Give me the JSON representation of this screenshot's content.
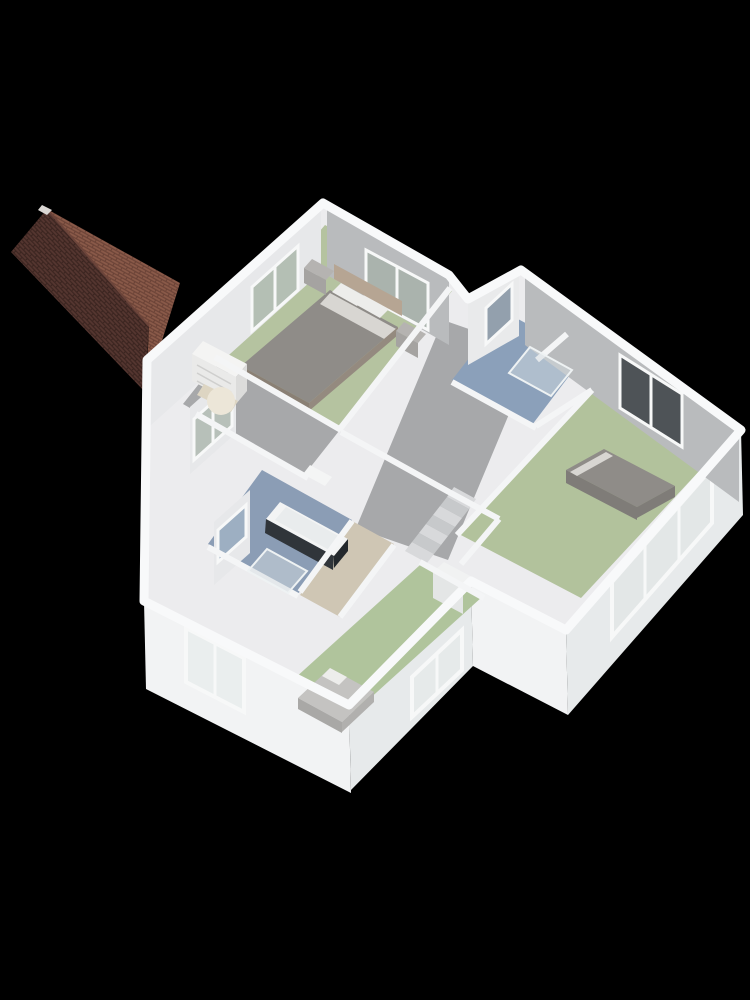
{
  "scene": {
    "type": "isometric-3d-floorplan-render",
    "view": "dollhouse-top",
    "background": "#000000"
  },
  "colors": {
    "background": "#000000",
    "roof_dark": "#553630",
    "roof_dark_line": "#3a241f",
    "roof_light": "#8a5a49",
    "roof_light_line": "#6a4236",
    "roof_ridge": "#6b443a",
    "roof_cap": "#dad6d3",
    "exterior_south": "#f2f3f4",
    "exterior_east": "#e7eaeb",
    "backdrop": "#ececee",
    "wall_top": "#f8f9fa",
    "wall_top_interior": "#f4f5f6",
    "interior_gray": "#b9bbbd",
    "interior_light": "#e7e8ea",
    "interior_light2": "#e9eaeb",
    "floor_master": "#b5c3a0",
    "floor_hall": "#a7a8aa",
    "floor_shower_room": "#8ba0ba",
    "floor_bedroom_right": "#b2c29c",
    "floor_bathroom": "#8b9db5",
    "floor_corridor": "#cfc6b4",
    "floor_bedroom_bottom": "#b0c49c",
    "window_frame": "#f7f8f8",
    "glass_master_west": "#b4bfb4",
    "glass_master_north": "#aab3ad",
    "glass_shower_west": "#93a0ad",
    "glass_bedroom_north": "#4e5357",
    "glass_bedroom_east": "#e3e7e7",
    "glass_landing": "#b7c0b9",
    "glass_bath": "#9dafc2",
    "glass_south": "#eaeeee",
    "glass_bottom_east": "#e6eaea",
    "bed_duvet": "#8f8c88",
    "bed_duvet_dark": "#7f7c78",
    "bed_sheet": "#d8d6d2",
    "bed_pillow": "#ededeb",
    "bed_headboard": "#b6a593",
    "bed_base": "#8a8075",
    "bed_base2": "#948a7f",
    "nightstand": "#b5b3b1",
    "nightstand_front": "#a5a3a1",
    "dresser_top": "#f4f4f3",
    "dresser_front": "#eaeae9",
    "dresser_side": "#dcdcdb",
    "dresser_line": "#cfcfce",
    "armchair": "#ece6d8",
    "armchair_dark": "#ddd5c2",
    "tub_rim": "#f3f4f4",
    "tub_inner": "#e9eced",
    "tub_panel": "#30353a",
    "tub_panel2": "#23282c",
    "basin": "#f4f5f5",
    "glass_fill": "#d3dcdf",
    "glass_edge": "#eef2f3",
    "single_bed": "#c4c3c1",
    "single_bed_side": "#a9a8a6",
    "single_bed_side2": "#b1b0ae",
    "wardrobe_top": "#f1f2f2",
    "wardrobe_front": "#e4e6e6",
    "step_light": "#d8d9db",
    "step_dark": "#c7c9cb"
  },
  "rooms": [
    {
      "name": "master-bedroom",
      "floor_color_key": "floor_master"
    },
    {
      "name": "shower-room",
      "floor_color_key": "floor_shower_room"
    },
    {
      "name": "bedroom-right",
      "floor_color_key": "floor_bedroom_right"
    },
    {
      "name": "bathroom",
      "floor_color_key": "floor_bathroom"
    },
    {
      "name": "landing-hall",
      "floor_color_key": "floor_hall"
    },
    {
      "name": "corridor",
      "floor_color_key": "floor_corridor"
    },
    {
      "name": "bedroom-bottom",
      "floor_color_key": "floor_bedroom_bottom"
    }
  ],
  "furniture": [
    {
      "room": "master-bedroom",
      "items": [
        "double-bed",
        "headboard",
        "pillows",
        "nightstand-left",
        "nightstand-right",
        "dresser",
        "armchair"
      ]
    },
    {
      "room": "shower-room",
      "items": [
        "shower-enclosure"
      ]
    },
    {
      "room": "bathroom",
      "items": [
        "bathtub",
        "shower-enclosure",
        "washbasin"
      ]
    },
    {
      "room": "bedroom-right",
      "items": [
        "double-bed"
      ]
    },
    {
      "room": "bedroom-bottom",
      "items": [
        "single-bed",
        "wardrobe"
      ]
    },
    {
      "room": "landing-hall",
      "items": [
        "winder-staircase"
      ]
    }
  ],
  "windows": [
    {
      "name": "master-west-window"
    },
    {
      "name": "master-north-window"
    },
    {
      "name": "shower-room-west-window"
    },
    {
      "name": "bedroom-right-north-window"
    },
    {
      "name": "bedroom-right-east-window-3pane"
    },
    {
      "name": "landing-west-window"
    },
    {
      "name": "bathroom-west-window"
    },
    {
      "name": "south-wall-window-2pane"
    },
    {
      "name": "bedroom-bottom-east-window-2pane"
    }
  ],
  "roof": {
    "name": "gabled-roof-annex",
    "tiles": "brown"
  }
}
